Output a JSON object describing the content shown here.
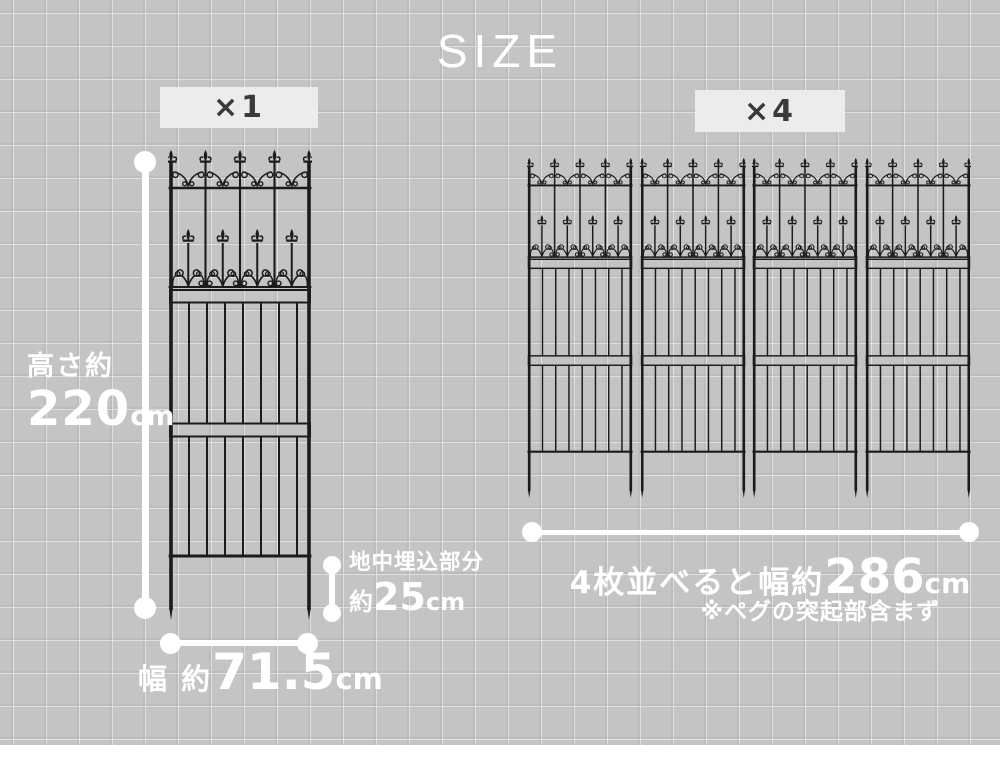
{
  "title": "SIZE",
  "colors": {
    "background": "#c4c4c4",
    "grid_line": "#cdcdcd",
    "fence": "#1b1b1b",
    "dimension": "#ffffff",
    "badge_background": "#ececec",
    "badge_text": "#3a3a3a"
  },
  "single": {
    "badge": "×1",
    "height_label": "高さ約",
    "height_value": "220",
    "height_unit": "cm",
    "width_label": "幅 約",
    "width_value": "71.5",
    "width_unit": "cm",
    "buried_label": "地中埋込部分",
    "buried_prefix": "約",
    "buried_value": "25",
    "buried_unit": "cm"
  },
  "group": {
    "badge": "×4",
    "width_label": "4枚並べると幅約",
    "width_value": "286",
    "width_unit": "cm",
    "note": "※ペグの突起部含まず"
  }
}
